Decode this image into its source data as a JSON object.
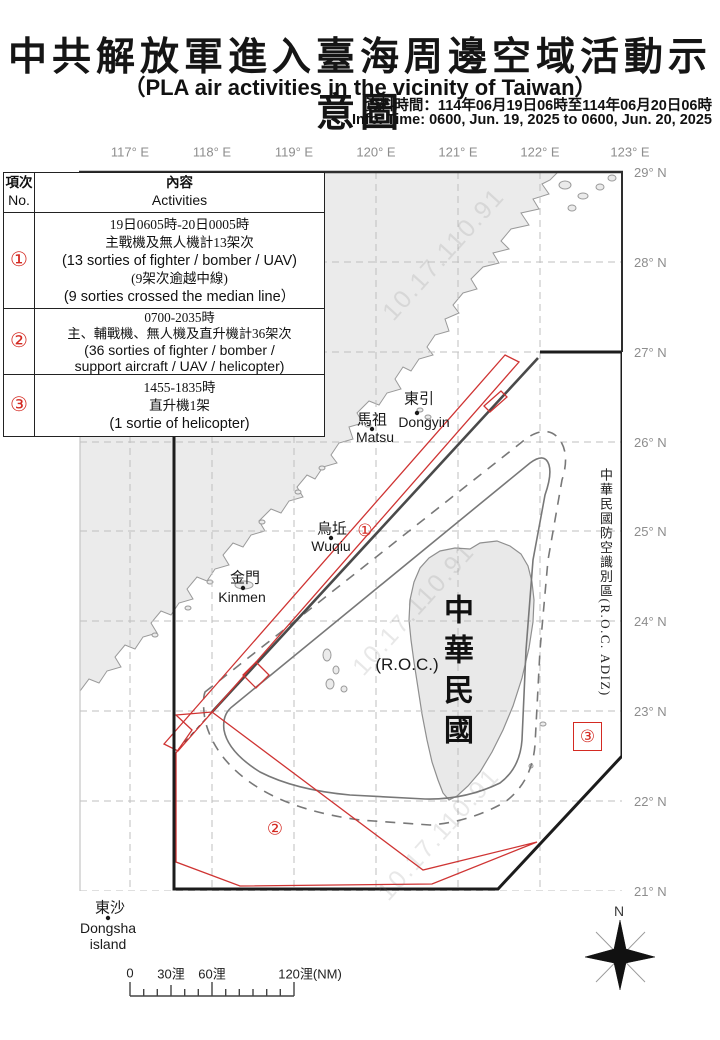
{
  "header": {
    "title_zh": "中共解放軍進入臺海周邊空域活動示意圖",
    "subtitle_en": "（PLA air activities in the vicinity of Taiwan）",
    "info_zh": "資料時間：114年06月19日06時至114年06月20日06時",
    "info_en": "Info. Time: 0600, Jun. 19, 2025 to 0600, Jun. 20, 2025"
  },
  "axes": {
    "lon_labels": [
      "117° E",
      "118° E",
      "119° E",
      "120° E",
      "121° E",
      "122° E",
      "123° E"
    ],
    "lat_labels": [
      "29° N",
      "28° N",
      "27° N",
      "26° N",
      "25° N",
      "24° N",
      "23° N",
      "22° N",
      "21° N"
    ]
  },
  "table": {
    "header": {
      "col1_zh": "項次",
      "col1_en": "No.",
      "col2_zh": "內容",
      "col2_en": "Activities"
    },
    "rows": [
      {
        "no": "①",
        "lines": [
          "19日0605時-20日0005時",
          "主戰機及無人機計13架次",
          "(13 sorties of fighter / bomber / UAV)",
          "(9架次逾越中線)",
          "(9 sorties crossed the median line）"
        ]
      },
      {
        "no": "②",
        "lines": [
          "0700-2035時",
          "主、輔戰機、無人機及直升機計36架次",
          "(36 sorties of fighter / bomber /",
          "support aircraft / UAV / helicopter)"
        ]
      },
      {
        "no": "③",
        "lines": [
          "1455-1835時",
          "直升機1架",
          "(1 sortie of helicopter)"
        ]
      }
    ]
  },
  "map": {
    "labels": {
      "dongyin_zh": "東引",
      "dongyin_en": "Dongyin",
      "matsu_zh": "馬祖",
      "matsu_en": "Matsu",
      "wuqiu_zh": "烏坵",
      "wuqiu_en": "Wuqiu",
      "kinmen_zh": "金門",
      "kinmen_en": "Kinmen",
      "dongsha_zh": "東沙",
      "dongsha_en1": "Dongsha",
      "dongsha_en2": "island",
      "taiwan_vertical": "中華民國",
      "roc": "(R.O.C.)",
      "adiz_vertical": "中華民國防空識別區(R.O.C. ADIZ)"
    },
    "markers": {
      "m1": "①",
      "m2": "②",
      "m3": "③"
    },
    "watermark": "10.17.110.91",
    "compass_n": "N"
  },
  "scalebar": {
    "t0": "0",
    "t30": "30浬",
    "t60": "60浬",
    "t120": "120浬(NM)"
  },
  "colors": {
    "red": "#cf3433",
    "adiz_black": "#1c1c1c",
    "median_gray": "#4a4a4a",
    "zone_gray": "#787878",
    "land": "#ebebeb",
    "coast": "#9a9a9a",
    "grid": "#bfbfbf"
  }
}
